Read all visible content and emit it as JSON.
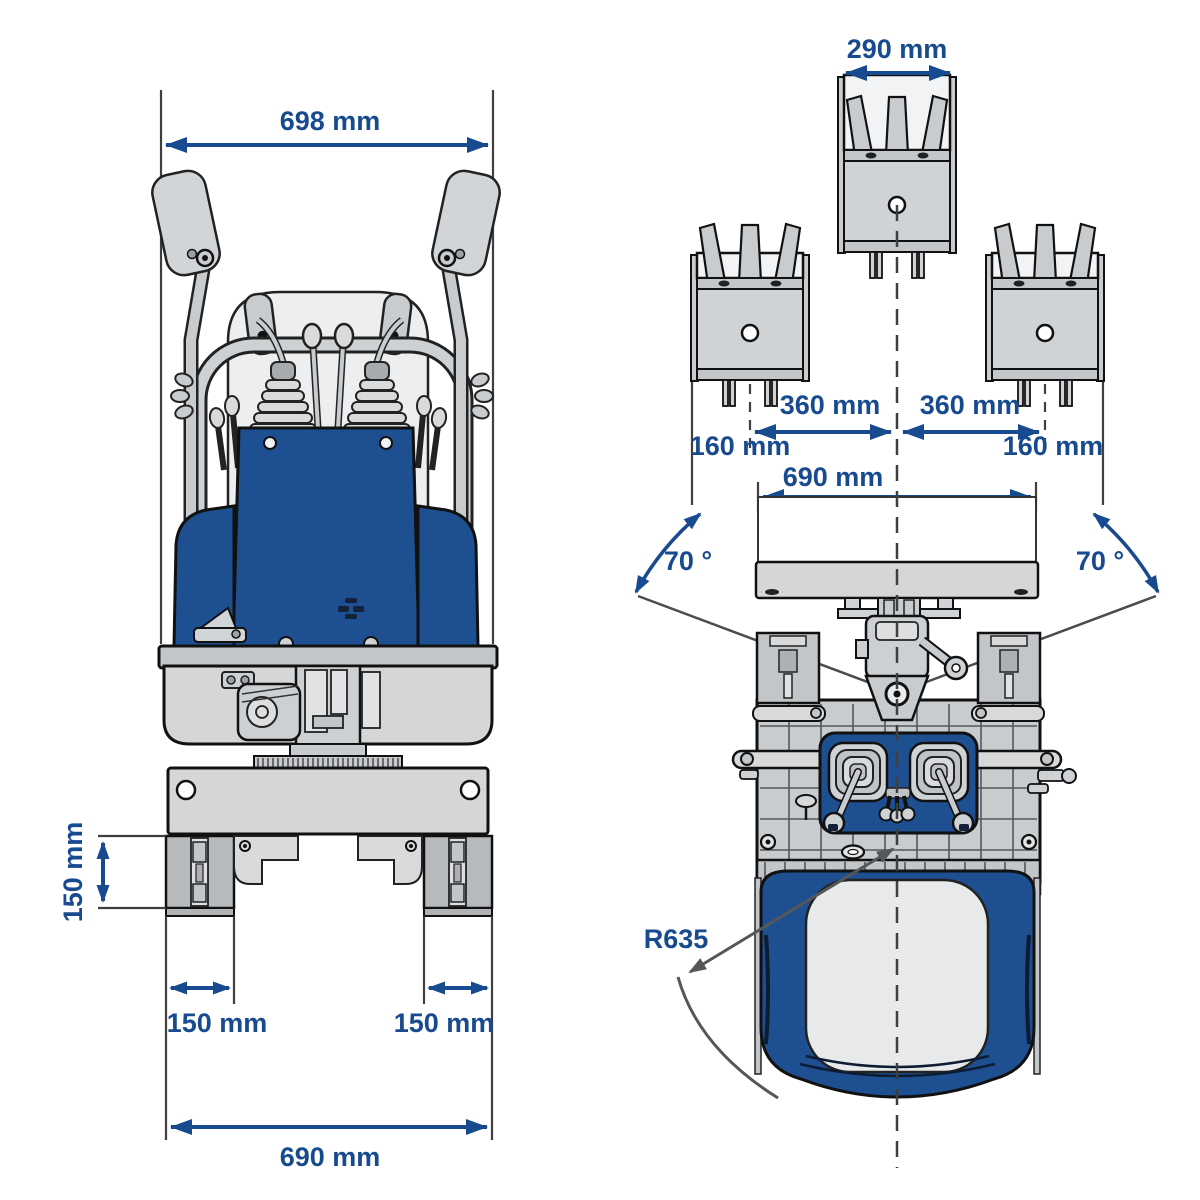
{
  "diagram": {
    "subject": "compact tracked mini-dumper dimension drawing, front view and top view",
    "colors": {
      "dimension_blue": "#174a8f",
      "machine_blue": "#1e4f90",
      "machine_light_gray": "#d4d6d8",
      "machine_mid_gray": "#c3c6c8",
      "outline_dark": "#111111",
      "leader_gray": "#55585a"
    },
    "front_view": {
      "overall_width_top": "698 mm",
      "track_height": "150 mm",
      "track_width_left": "150 mm",
      "track_width_right": "150 mm",
      "overall_width_bottom": "690 mm"
    },
    "top_view": {
      "bucket_width": "290 mm",
      "sideshift_left": "360 mm",
      "sideshift_right": "360 mm",
      "edge_offset_left": "160 mm",
      "edge_offset_right": "160 mm",
      "blade_width": "690 mm",
      "blade_angle_left": "70 °",
      "blade_angle_right": "70 °",
      "turning_radius": "R635"
    }
  }
}
